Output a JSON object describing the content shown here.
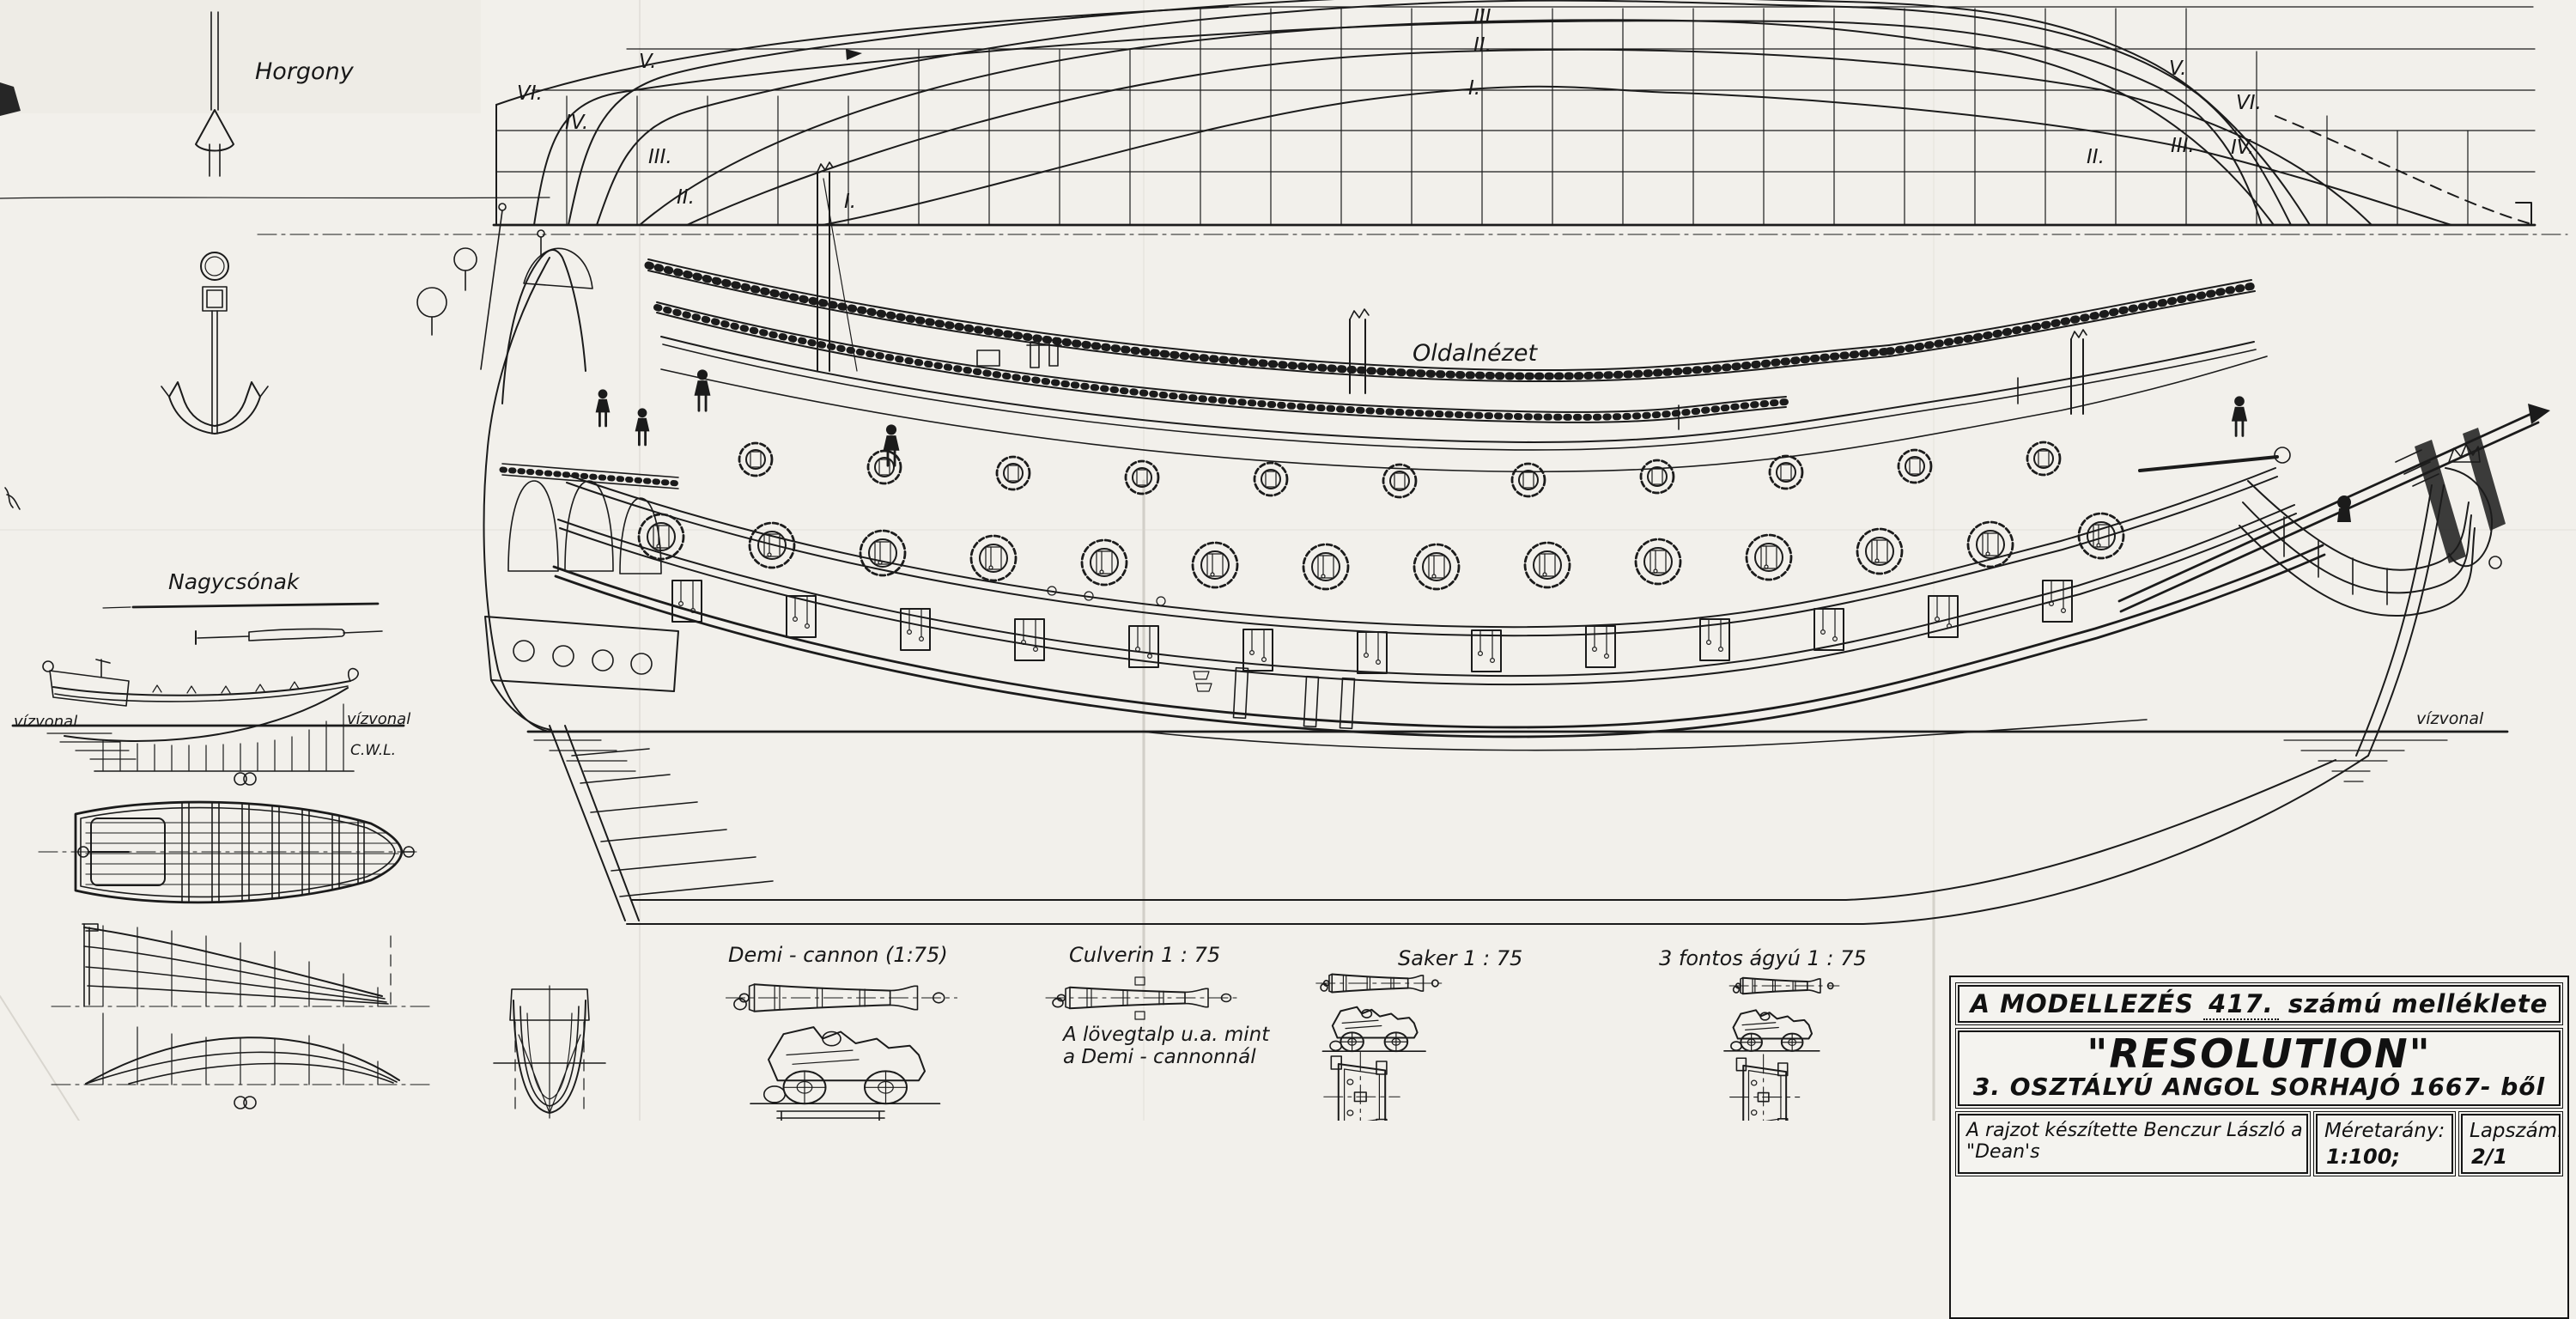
{
  "labels": {
    "anchor": "Horgony",
    "longboat": "Nagycsónak",
    "side_view": "Oldalnézet",
    "waterline_left": "vízvonal",
    "waterline_boat": "vízvonal",
    "waterline_bow": "vízvonal",
    "cwl": "C.W.L."
  },
  "lines_plan": {
    "labels_left": [
      "VI.",
      "V.",
      "IV.",
      "III.",
      "II.",
      "I."
    ],
    "labels_mid": [
      "III.",
      "II.",
      "I."
    ],
    "labels_right": [
      "II.",
      "III.",
      "IV.",
      "V.",
      "VI."
    ]
  },
  "cannons": {
    "demi": {
      "label": "Demi - cannon  (1:75)"
    },
    "culverin": {
      "label": "Culverin   1 : 75",
      "note_line1": "A lövegtalp  u.a. mint",
      "note_line2": "a Demi - cannonnál"
    },
    "saker": {
      "label": "Saker   1 : 75"
    },
    "three_pounder": {
      "label": "3 fontos  ágyú   1 : 75"
    }
  },
  "title_block": {
    "series_prefix": "A  MODELLEZÉS",
    "series_number": "417.",
    "series_suffix": "számú  melléklete",
    "ship_name": "\"RESOLUTION\"",
    "subtitle": "3. OSZTÁLYÚ  ANGOL  SORHAJÓ  1667- ből",
    "credit": "A rajzot készítette  Benczur  László   a \"Dean's",
    "scale_label": "Méretarány:",
    "scale_value": "1:100;  1:75",
    "sheet_label": "Lapszám:",
    "sheet_value": "2/1"
  },
  "colors": {
    "ink": "#1b1b1b",
    "paper": "#f2f0eb"
  }
}
